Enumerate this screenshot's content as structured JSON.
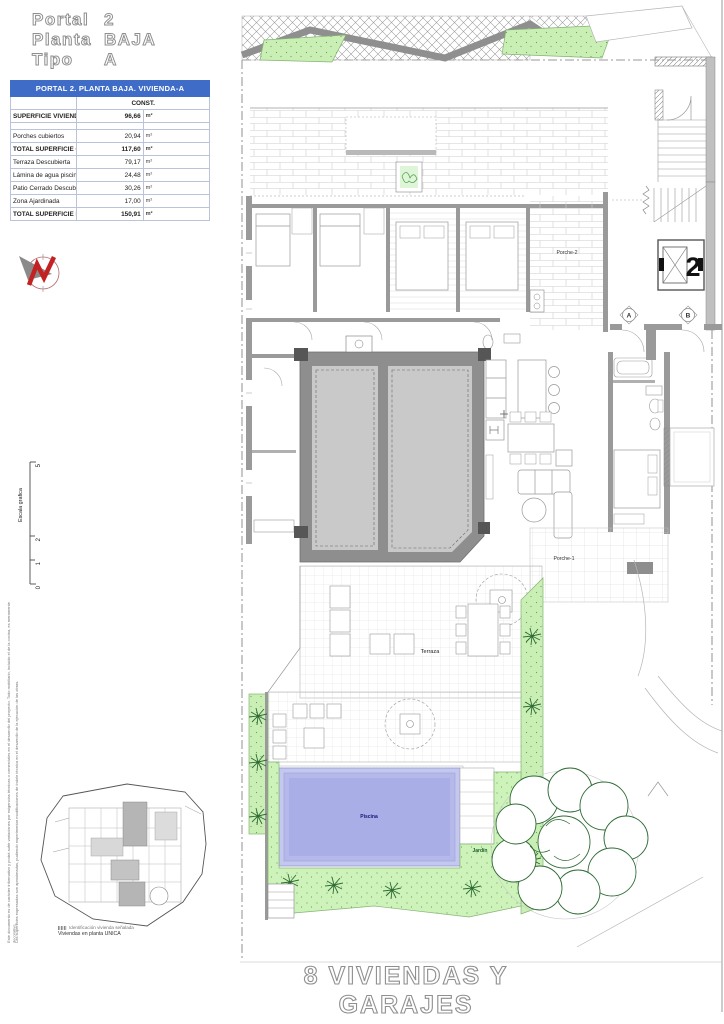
{
  "header": {
    "rows": [
      {
        "label": "Portal",
        "value": "2"
      },
      {
        "label": "Planta",
        "value": "BAJA"
      },
      {
        "label": "Tipo",
        "value": "A"
      }
    ]
  },
  "area_table": {
    "title": "PORTAL 2. PLANTA BAJA. VIVIENDA-A",
    "col_header": "CONST.",
    "unit": "m²",
    "rows": [
      {
        "label": "SUPERFICIE VIVIENDA CUBIERTA",
        "value": "96,66",
        "bold": true
      },
      {
        "label": "Porches cubiertos",
        "value": "20,94",
        "bold": false
      },
      {
        "label": "TOTAL SUPERFICIE CUBIERTA",
        "value": "117,60",
        "bold": true
      },
      {
        "label": "Terraza Descubierta",
        "value": "79,17",
        "bold": false
      },
      {
        "label": "Lámina de agua piscina",
        "value": "24,48",
        "bold": false
      },
      {
        "label": "Patio Cerrado Descubierto",
        "value": "30,26",
        "bold": false
      },
      {
        "label": "Zona Ajardinada",
        "value": "17,00",
        "bold": false
      },
      {
        "label": "TOTAL SUPERFICIE DESCUBIERTA",
        "value": "150,91",
        "bold": true
      }
    ]
  },
  "plan_labels": {
    "porche2": "Porche-2",
    "porche1": "Porche-1",
    "terraza": "Terraza",
    "piscina": "Piscina",
    "jardin": "Jardín",
    "portal_number": "2",
    "section_a": "A",
    "section_b": "B"
  },
  "scale": {
    "label": "Escala grafica",
    "ticks": [
      "5",
      "2",
      "1",
      "0"
    ]
  },
  "keyplan": {
    "legend_line1": "Identificación vivienda señalada",
    "legend_line2": "Viviendas en planta UNICA"
  },
  "side_note": {
    "line1": "Este documento es de carácter informativo y podrá sufrir variaciones por exigencias técnicas o comerciales en el desarrollo del proyecto. Todo mobiliario, incluido el de la cocina, es meramente decorativo.",
    "line2": "Las superficies expresadas son aproximadas, pudiendo experimentar modificaciones de índole técnica en el desarrollo de la ejecución de las obras."
  },
  "footer": {
    "title": "8 VIVIENDAS Y GARAJES"
  },
  "colors": {
    "table_header": "#3e6cc7",
    "pool": "#a9aee6",
    "garden": "#cdf3ba",
    "wall": "#9a9a9a"
  }
}
